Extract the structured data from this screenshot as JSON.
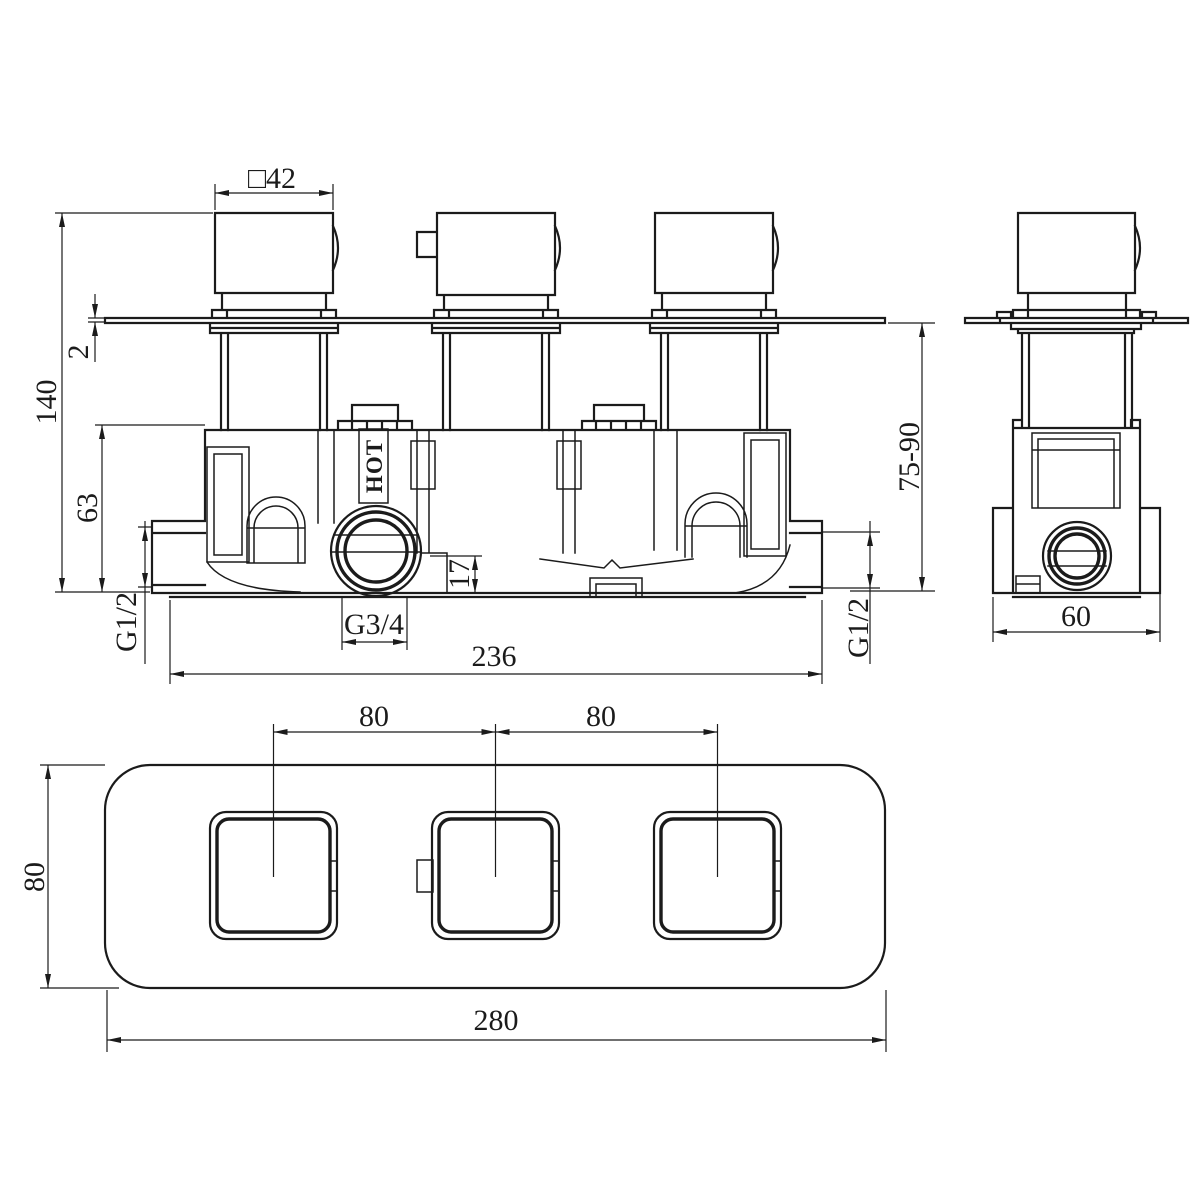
{
  "drawing": {
    "type": "technical-dimension-drawing",
    "subject": "3-handle concealed thermostatic shower valve rough-in",
    "style": {
      "line_color": "#1b1b1b",
      "background": "#ffffff"
    },
    "front_view": {
      "labels": {
        "handle_width": "□42",
        "plate_thickness": "2",
        "overall_height": "140",
        "body_height": "63",
        "left_inlet_thread": "G1/2",
        "right_inlet_thread": "G1/2",
        "bottom_outlet_thread": "G3/4",
        "outlet_step_height": "17",
        "valve_body_width": "236",
        "hot_marking": "HOT"
      }
    },
    "side_view": {
      "labels": {
        "mounting_depth_range": "75-90",
        "body_depth": "60"
      }
    },
    "plan_view": {
      "labels": {
        "handle_pitch_left": "80",
        "handle_pitch_right": "80",
        "plate_height": "80",
        "plate_width": "280"
      }
    }
  }
}
